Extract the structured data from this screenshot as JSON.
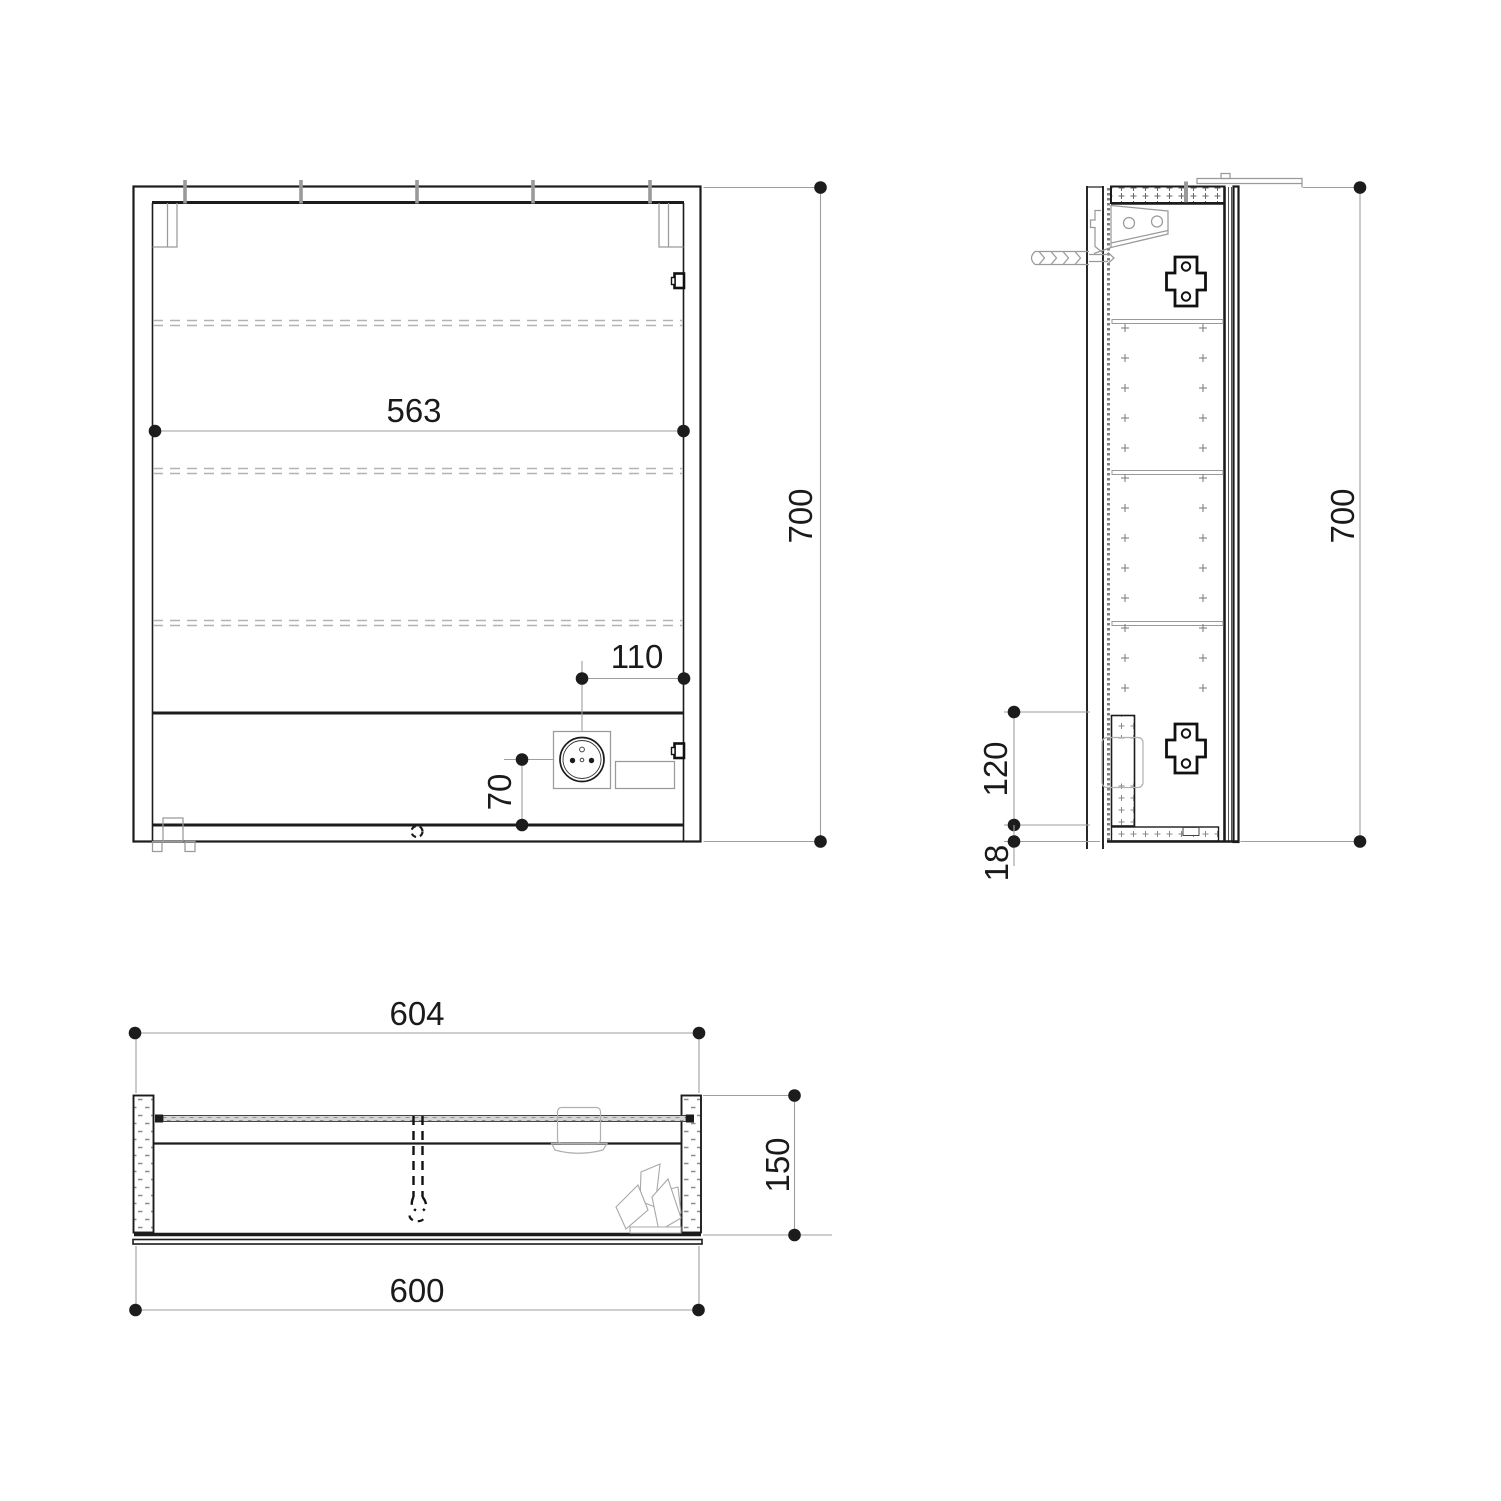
{
  "views": {
    "front": {
      "dims": {
        "inner_width": "563",
        "height": "700",
        "socket_offset_x": "110",
        "socket_offset_y": "70"
      }
    },
    "side": {
      "dims": {
        "height": "700",
        "socket_zone_height": "120",
        "bottom_panel_thickness": "18"
      }
    },
    "plan": {
      "dims": {
        "overall_width": "604",
        "depth": "150",
        "carcass_width": "600"
      }
    }
  },
  "style": {
    "line_color": "#1c1c1c",
    "detail_color": "#9a9a9a",
    "dimension_color": "#999999",
    "dot_color": "#1c1c1c",
    "background": "#ffffff"
  }
}
